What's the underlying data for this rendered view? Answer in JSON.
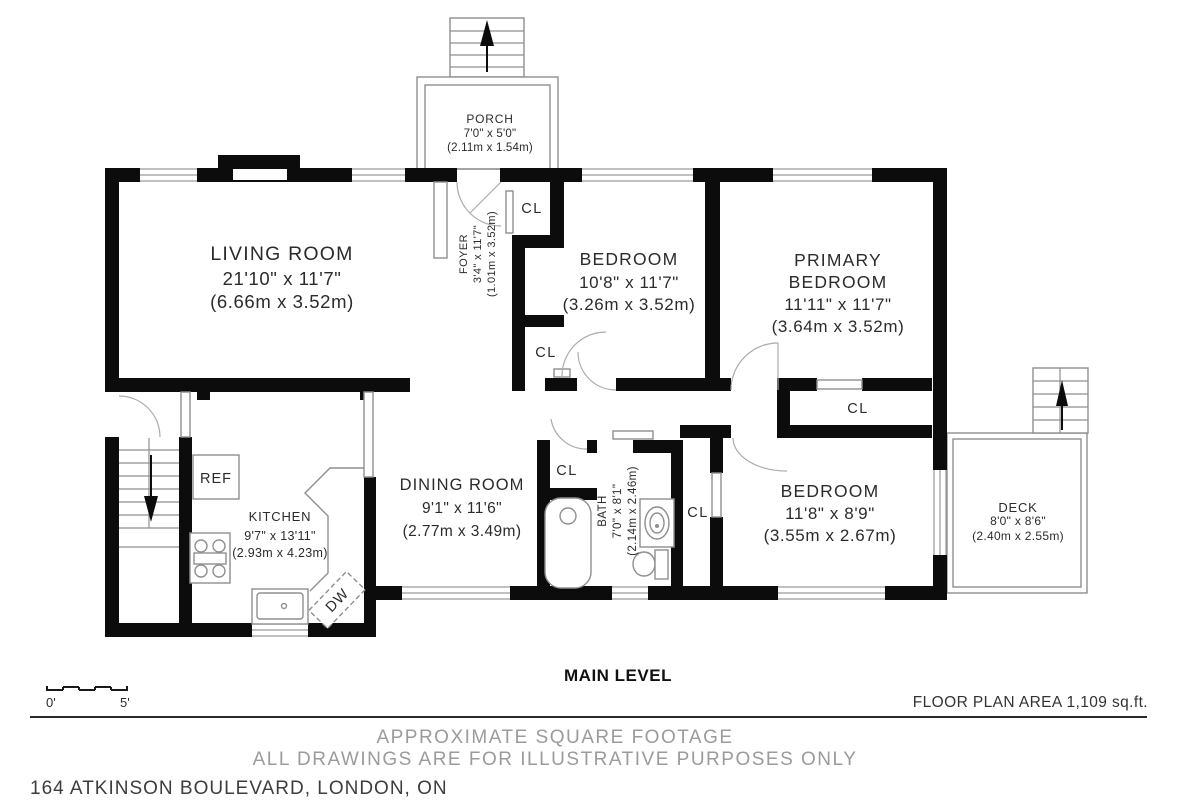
{
  "plan": {
    "rooms": {
      "porch": {
        "name": "PORCH",
        "size_imperial": "7'0\" x 5'0\"",
        "size_metric": "(2.11m x 1.54m)"
      },
      "living": {
        "name": "LIVING ROOM",
        "size_imperial": "21'10\" x 11'7\"",
        "size_metric": "(6.66m x 3.52m)"
      },
      "foyer": {
        "name": "FOYER",
        "size_imperial": "3'4\" x 11'7\"",
        "size_metric": "(1.01m x 3.52m)"
      },
      "bedroom2": {
        "name": "BEDROOM",
        "size_imperial": "10'8\" x 11'7\"",
        "size_metric": "(3.26m x 3.52m)"
      },
      "primary": {
        "name_line1": "PRIMARY",
        "name_line2": "BEDROOM",
        "size_imperial": "11'11\" x 11'7\"",
        "size_metric": "(3.64m x 3.52m)"
      },
      "dining": {
        "name": "DINING ROOM",
        "size_imperial": "9'1\" x 11'6\"",
        "size_metric": "(2.77m x 3.49m)"
      },
      "kitchen": {
        "name": "KITCHEN",
        "size_imperial": "9'7\" x 13'11\"",
        "size_metric": "(2.93m x 4.23m)"
      },
      "bath": {
        "name": "BATH",
        "size_imperial": "7'0\" x 8'1\"",
        "size_metric": "(2.14m x 2.46m)"
      },
      "bedroom3": {
        "name": "BEDROOM",
        "size_imperial": "11'8\" x 8'9\"",
        "size_metric": "(3.55m x 2.67m)"
      },
      "deck": {
        "name": "DECK",
        "size_imperial": "8'0\" x 8'6\"",
        "size_metric": "(2.40m x 2.55m)"
      }
    },
    "closet_label": "CL",
    "appliances": {
      "fridge": "REF",
      "dishwasher": "DW"
    }
  },
  "footer": {
    "level_title": "MAIN LEVEL",
    "floor_area": "FLOOR PLAN AREA 1,109 sq.ft.",
    "scale_start": "0'",
    "scale_end": "5'",
    "disclaimer_line1": "APPROXIMATE SQUARE FOOTAGE",
    "disclaimer_line2": "ALL DRAWINGS ARE FOR ILLUSTRATIVE PURPOSES ONLY",
    "address": "164 ATKINSON BOULEVARD, LONDON, ON"
  },
  "colors": {
    "wall": "#0c0c0c",
    "thin_line": "#8f8f8f",
    "room_text": "#2b2b2b",
    "muted_text": "#9b9b9b",
    "address_text": "#3d3d3d"
  }
}
